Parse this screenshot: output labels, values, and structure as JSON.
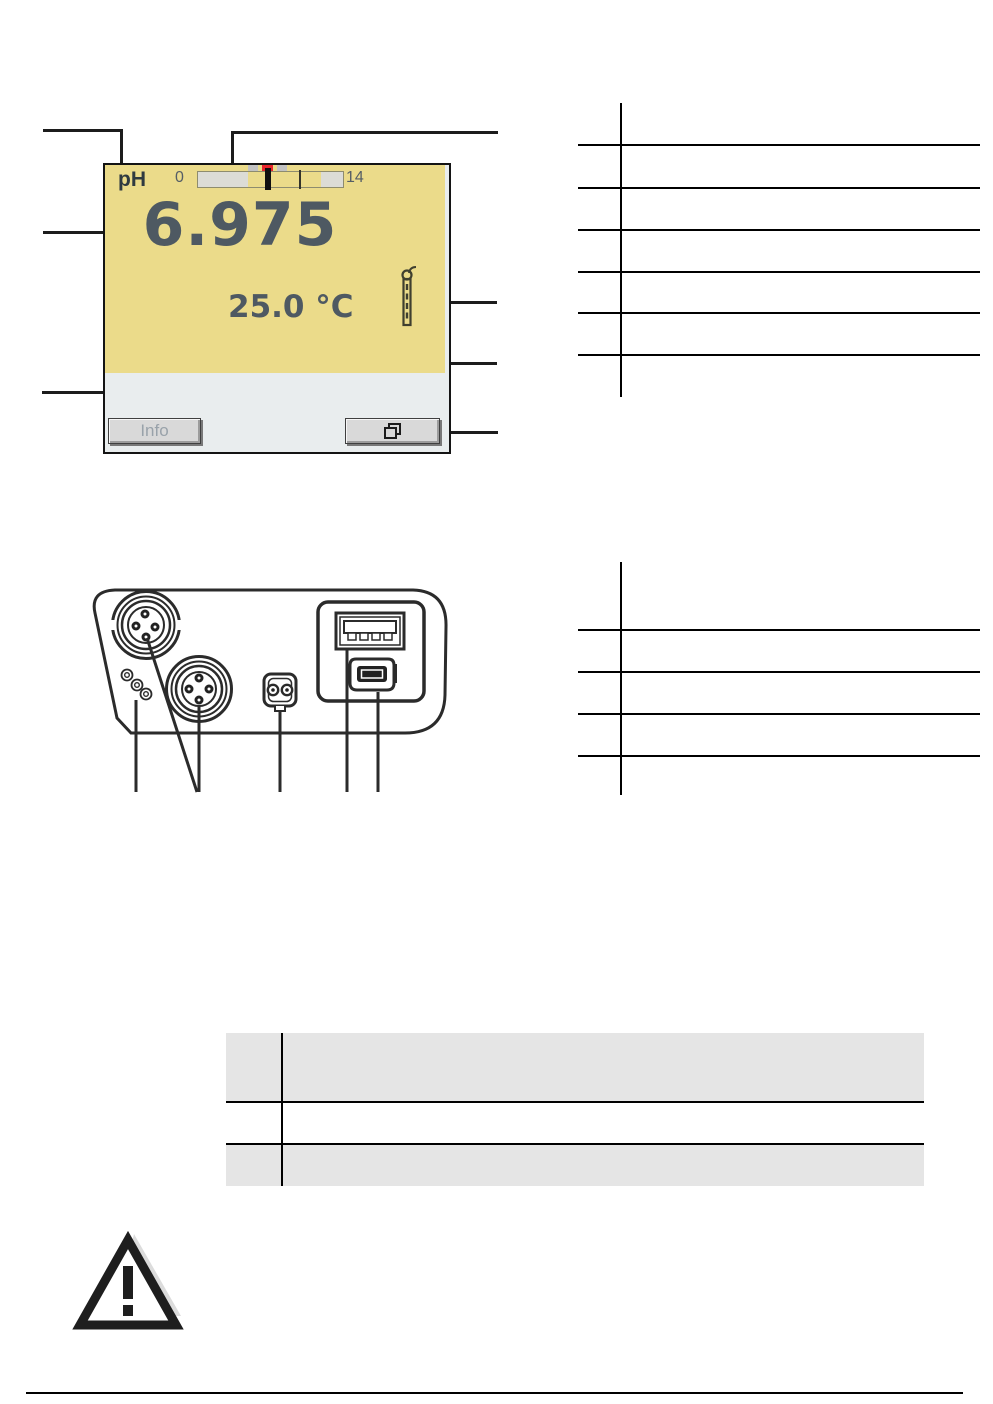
{
  "device_display": {
    "mode_label": "pH",
    "scale_min": "0",
    "scale_max": "14",
    "reading": "6.975",
    "temperature": "25.0 °C",
    "info_button_label": "Info",
    "colors": {
      "screen_bg": "#EBDB8A",
      "status_bar_bg": "#E9EDEE",
      "digits": "#4E5962",
      "scale_mark_red": "#E8262C",
      "scale_mark_gray": "#C2C2C2",
      "scale_segment_gray": "#DCDCD6",
      "button_face": "#D9D9D9",
      "button_label": "#99A2AA"
    },
    "icons": [
      "electrode-icon",
      "window-stack-icon"
    ]
  },
  "connector_panel": {
    "icons": [
      "din-socket-icon",
      "din-socket-icon",
      "service-screws-icon",
      "power-socket-icon",
      "usb-a-port-icon",
      "usb-mini-port-icon"
    ]
  },
  "warning": {
    "icon": "warning-triangle-icon"
  },
  "spec_table": {
    "row_fills": [
      "#E5E5E5",
      "#ffffff",
      "#E5E5E5"
    ]
  }
}
